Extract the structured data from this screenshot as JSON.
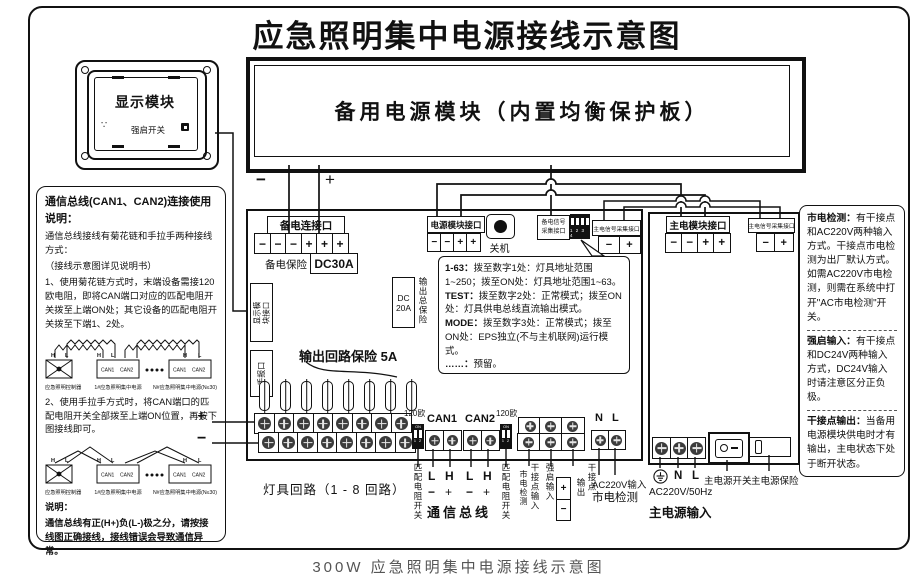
{
  "title": "应急照明集中电源接线示意图",
  "caption": "300W 应急照明集中电源接线示意图",
  "display_module": {
    "name": "显示模块",
    "force_switch": "强启开关",
    "dots": "∵"
  },
  "backup_module": {
    "name": "备用电源模块（内置均衡保护板）",
    "wire_minus": "−",
    "wire_plus": "+"
  },
  "left_panel": {
    "heading": "通信总线(CAN1、CAN2)连接使用说明：",
    "line1": "通信总线接线有菊花链和手拉手两种接线方式：",
    "line2": "（接线示意图详见说明书）",
    "item1": "1、使用菊花链方式时，末端设备需接120欧电阻，即将CAN端口对应的匹配电阻开关拨至上端ON处；其它设备的匹配电阻开关拨至下端1、2处。",
    "item2": "2、使用手拉手方式时，将CAN端口的匹配电阻开关全部拨至上端ON位置，再按下图接线即可。",
    "note_heading": "说明：",
    "note_body": "通信总线有正(H+)负(L-)极之分，请按接线图正确接线，接线错误会导致通信异常。",
    "diagram": {
      "controller": "应急照明控制器",
      "first": "1#应急照明集中电源",
      "nth": "N#应急照明集中电源(N≤30)",
      "can1": "CAN1",
      "can2": "CAN2",
      "h": "H",
      "l": "L"
    }
  },
  "main_unit": {
    "backup_port": {
      "label": "备电连接口",
      "t": [
        "−",
        "−",
        "−",
        "+",
        "+",
        "+"
      ]
    },
    "backup_fuse_label": "备电保险",
    "backup_fuse_value": "DC30A",
    "display_port_line1": "显示模",
    "display_port_line2": "块接口",
    "manual_port": "手报口",
    "psu_port": {
      "label": "电源模块接口",
      "t": [
        "−",
        "−",
        "+",
        "+"
      ]
    },
    "shutdown_label": "关机",
    "backup_signal_line1": "备电信号",
    "backup_signal_line2": "采集接口",
    "dip_numbers": "1 2 3 4",
    "dip_on": "ON",
    "dip_12": "1 2",
    "main_signal": {
      "label": "主电信号采集接口",
      "t": [
        "−",
        "+"
      ]
    },
    "total_fuse_line1": "DC",
    "total_fuse_line2": "20A",
    "total_fuse_label": "输出总保险",
    "circuit_fuse_label": "输出回路保险 5A",
    "notes": [
      {
        "key": "1-63：",
        "text": "拨至数字1处：灯具地址范围1~250；拨至ON处：灯具地址范围1~63。"
      },
      {
        "key": "TEST：",
        "text": "拨至数字2处：正常模式；拨至ON处：灯具供电总线直流输出模式。"
      },
      {
        "key": "MODE：",
        "text": "拨至数字3处：正常模式；拨至ON处：EPS独立(不与主机联网)运行模式。"
      },
      {
        "key": "……：",
        "text": "预留。"
      }
    ],
    "lamp_plus": "+",
    "lamp_minus": "−",
    "ohm": "120欧",
    "can1": "CAN1",
    "can2": "CAN2",
    "n": "N",
    "l": "L"
  },
  "bottom_labels": {
    "lamp_circuits": "灯具回路（1 - 8 回路）",
    "match1": "匹配电阻开关",
    "match2": "匹配电阻开关",
    "pins": [
      {
        "p": "L",
        "s": "−"
      },
      {
        "p": "H",
        "s": "+"
      },
      {
        "p": "L",
        "s": "−"
      },
      {
        "p": "H",
        "s": "+"
      }
    ],
    "comm_bus": "通信总线",
    "dry_in_main": "干接点输入",
    "dry_in_sub": "市电检测",
    "force_label": "强启输入",
    "force_plus": "+",
    "force_minus": "−",
    "dry_out_main": "干接点",
    "dry_out_sub": "输出",
    "ac_line1": "AC220V输入",
    "ac_line2": "市电检测"
  },
  "right_module": {
    "main_port": {
      "label": "主电模块接口",
      "t": [
        "−",
        "−",
        "+",
        "+"
      ]
    },
    "main_signal": {
      "label": "主电信号采集接口",
      "t": [
        "−",
        "+"
      ]
    },
    "n": "N",
    "l": "L",
    "freq": "AC220V/50Hz",
    "input_label": "主电源输入",
    "switch_label": "主电源开关",
    "fuse_label": "主电源保险"
  },
  "right_panel": {
    "sections": [
      {
        "key": "市电检测：",
        "text": "有干接点和AC220V两种输入方式。干接点市电检测为出厂默认方式。如需AC220V市电检测，则需在系统中打开\"AC市电检测\"开关。"
      },
      {
        "key": "强启输入：",
        "text": "有干接点和DC24V两种输入方式，DC24V输入时请注意区分正负极。"
      },
      {
        "key": "干接点输出：",
        "text": "当备用电源模块供电时才有输出，主电状态下处于断开状态。"
      }
    ]
  }
}
